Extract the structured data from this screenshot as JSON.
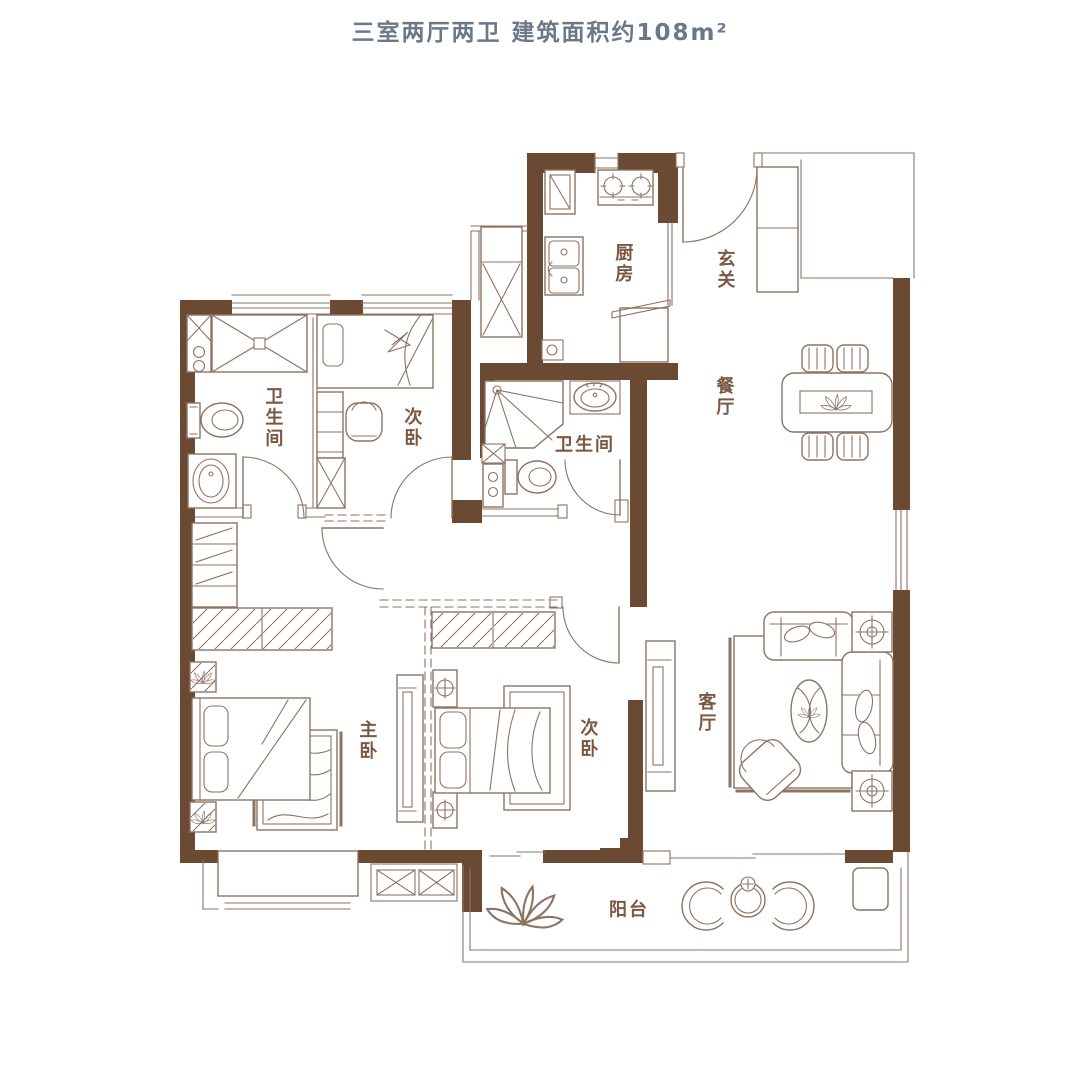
{
  "title": "三室两厅两卫  建筑面积约108m²",
  "summary": {
    "bedrooms": 3,
    "halls": 2,
    "bathrooms": 2,
    "area_sqm_approx": 108
  },
  "colors": {
    "wall": "#6b4a33",
    "line": "#8d7361",
    "label": "#7a5843",
    "title": "#6b7888"
  },
  "rooms": {
    "kitchen": {
      "label": "厨房"
    },
    "entry": {
      "label": "玄关"
    },
    "dining": {
      "label": "餐厅"
    },
    "bath_main": {
      "label": "卫生间"
    },
    "bedroom_top": {
      "label": "次卧"
    },
    "bath_second": {
      "label": "卫生间"
    },
    "master": {
      "label": "主卧"
    },
    "bedroom_second": {
      "label": "次卧"
    },
    "living": {
      "label": "客厅"
    },
    "balcony": {
      "label": "阳台"
    }
  }
}
